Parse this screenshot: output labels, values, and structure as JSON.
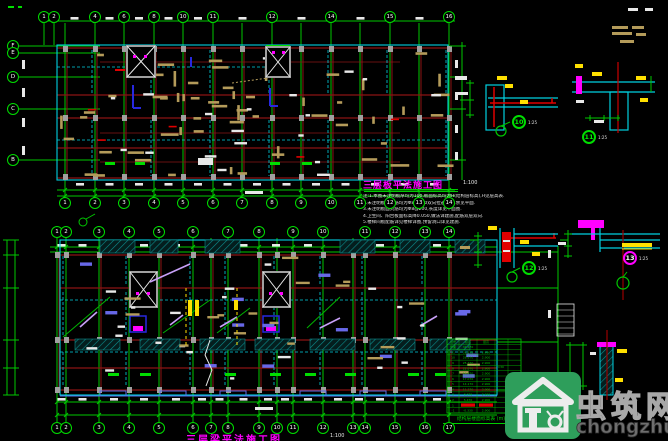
{
  "plan1": {
    "title": "三层板平法施工图",
    "scale": "1:100",
    "axes_top": [
      {
        "label": "1",
        "x": 44
      },
      {
        "label": "2",
        "x": 54
      },
      {
        "label": "4",
        "x": 95
      },
      {
        "label": "6",
        "x": 124
      },
      {
        "label": "8",
        "x": 154
      },
      {
        "label": "10",
        "x": 183
      },
      {
        "label": "11",
        "x": 213
      },
      {
        "label": "12",
        "x": 272
      },
      {
        "label": "14",
        "x": 331
      },
      {
        "label": "15",
        "x": 390
      },
      {
        "label": "16",
        "x": 449
      }
    ],
    "axes_bottom": [
      {
        "label": "1",
        "x": 65
      },
      {
        "label": "2",
        "x": 95
      },
      {
        "label": "3",
        "x": 124
      },
      {
        "label": "4",
        "x": 154
      },
      {
        "label": "5",
        "x": 183
      },
      {
        "label": "6",
        "x": 213
      },
      {
        "label": "7",
        "x": 242
      },
      {
        "label": "8",
        "x": 272
      },
      {
        "label": "9",
        "x": 301
      },
      {
        "label": "10",
        "x": 331
      },
      {
        "label": "11",
        "x": 360
      },
      {
        "label": "12",
        "x": 390
      },
      {
        "label": "13",
        "x": 419
      },
      {
        "label": "14",
        "x": 449
      }
    ],
    "axes_left": [
      {
        "label": "F",
        "y": 46
      },
      {
        "label": "E",
        "y": 53
      },
      {
        "label": "D",
        "y": 77
      },
      {
        "label": "C",
        "y": 109
      },
      {
        "label": "B",
        "y": 160
      }
    ]
  },
  "notes": [
    "注:1.本图未注明板厚均为100,板面标高均为H(结构层标高),H见层高表.",
    "2.未注明板底钢筋均为Φ8@200双向拉通布置,余见平面.",
    "3.未注明板面负筋均为Φ8@200,长度详见平面图.",
    "4.卫生间、阳台板面标高降0.050,做法详建施,配筋双层双向.",
    "5.楼梯间板配筋详见楼梯详图,预留洞口详见建施."
  ],
  "plan2": {
    "title": "三层梁平法施工图",
    "scale": "1:100",
    "axes_top": [
      {
        "label": "1",
        "x": 57
      },
      {
        "label": "2",
        "x": 66
      },
      {
        "label": "3",
        "x": 99
      },
      {
        "label": "4",
        "x": 129
      },
      {
        "label": "5",
        "x": 159
      },
      {
        "label": "6",
        "x": 193
      },
      {
        "label": "7",
        "x": 228
      },
      {
        "label": "8",
        "x": 259
      },
      {
        "label": "9",
        "x": 293
      },
      {
        "label": "10",
        "x": 323
      },
      {
        "label": "11",
        "x": 365
      },
      {
        "label": "12",
        "x": 395
      },
      {
        "label": "13",
        "x": 425
      },
      {
        "label": "14",
        "x": 449
      }
    ],
    "axes_bottom": [
      {
        "label": "1",
        "x": 57
      },
      {
        "label": "2",
        "x": 66
      },
      {
        "label": "3",
        "x": 99
      },
      {
        "label": "4",
        "x": 129
      },
      {
        "label": "5",
        "x": 159
      },
      {
        "label": "6",
        "x": 193
      },
      {
        "label": "7",
        "x": 211
      },
      {
        "label": "8",
        "x": 228
      },
      {
        "label": "9",
        "x": 259
      },
      {
        "label": "10",
        "x": 277
      },
      {
        "label": "11",
        "x": 293
      },
      {
        "label": "12",
        "x": 323
      },
      {
        "label": "13",
        "x": 353
      },
      {
        "label": "14",
        "x": 365
      },
      {
        "label": "15",
        "x": 395
      },
      {
        "label": "16",
        "x": 425
      },
      {
        "label": "17",
        "x": 449
      }
    ]
  },
  "details": [
    {
      "no": "10",
      "scale": "1:25"
    },
    {
      "no": "11",
      "scale": "1:25"
    },
    {
      "no": "12",
      "scale": "1:25"
    },
    {
      "no": "13",
      "scale": "1:25"
    }
  ],
  "table": {
    "caption": "结构层楼面标高表",
    "unit": "(m)",
    "header": [
      "层号",
      "标高",
      "层高"
    ],
    "merged": [
      "C30",
      "C25"
    ],
    "rows": [
      [
        "屋面",
        "34.470",
        ""
      ],
      [
        "11",
        "31.570",
        "2.900"
      ],
      [
        "10",
        "28.670",
        "2.900"
      ],
      [
        "9",
        "25.770",
        "2.900"
      ],
      [
        "8",
        "22.870",
        "2.900"
      ],
      [
        "7",
        "19.970",
        "2.900"
      ],
      [
        "6",
        "17.070",
        "2.900"
      ],
      [
        "5",
        "14.170",
        "2.900"
      ],
      [
        "4",
        "11.270",
        "2.900"
      ],
      [
        "3",
        "8.370",
        "2.900"
      ],
      [
        "2",
        "5.470",
        "2.900"
      ],
      [
        "1",
        "2.570",
        "2.900"
      ],
      [
        "-1",
        "-0.330",
        "2.900"
      ]
    ],
    "highlight_row_index": 11
  },
  "watermark": {
    "site_name": "虫筑网",
    "site_url": "chongzhu.cn",
    "logo_color": "#2E9E5B"
  },
  "colors": {
    "grid_green": "#00C800",
    "wall_red": "#8B1414",
    "beam_cyan": "#00D0E0",
    "rebar_khaki": "#B49B5A",
    "accent_magenta": "#FF00FF",
    "dim_white": "#E8E8E8"
  }
}
